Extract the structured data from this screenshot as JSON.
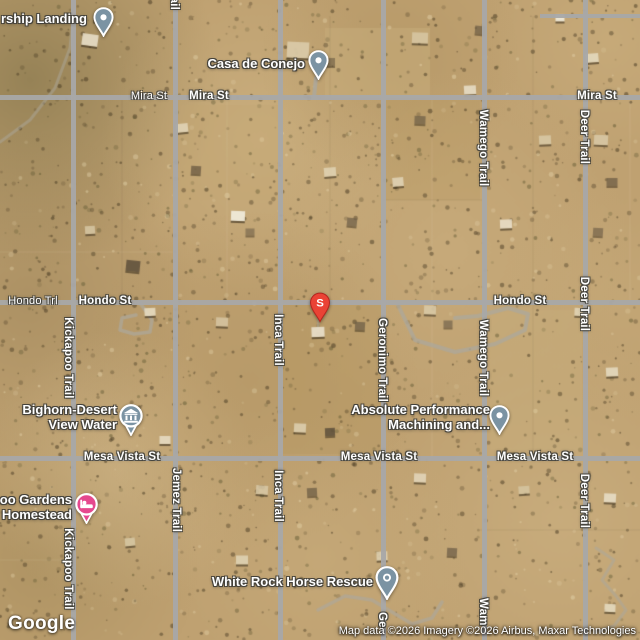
{
  "colors": {
    "terrain_base": "#bfa171",
    "road": "#a8a8a8",
    "poi_pin": "#7b93a3",
    "lodging_pin": "#e5488e",
    "search_pin": "#ea4335",
    "label_text": "#ffffff"
  },
  "search_marker": {
    "letter": "S"
  },
  "streets": [
    {
      "text": "z Trail"
    },
    {
      "text": "Mira St"
    },
    {
      "text": "Mira St"
    },
    {
      "text": "Mira St"
    },
    {
      "text": "Wamego Trail"
    },
    {
      "text": "Deer Trail"
    },
    {
      "text": "Hondo Trl"
    },
    {
      "text": "Hondo St"
    },
    {
      "text": "Hondo St"
    },
    {
      "text": "Kickapoo Trail"
    },
    {
      "text": "Inca Trail"
    },
    {
      "text": "Geronimo Trail"
    },
    {
      "text": "Wamego Trail"
    },
    {
      "text": "Deer Trail"
    },
    {
      "text": "Mesa Vista St"
    },
    {
      "text": "Mesa Vista St"
    },
    {
      "text": "Mesa Vista St"
    },
    {
      "text": "Jemez Trail"
    },
    {
      "text": "Inca Trail"
    },
    {
      "text": "Deer Trail"
    },
    {
      "text": "Kickapoo Trail"
    },
    {
      "text": "Ge"
    },
    {
      "text": "Wam"
    }
  ],
  "pois": {
    "rship_landing": {
      "line1": "rship Landing"
    },
    "casa_de_conejo": {
      "line1": "Casa de Conejo"
    },
    "bighorn": {
      "line1": "Bighorn-Desert",
      "line2": "View Water"
    },
    "absolute": {
      "line1": "Absolute Performance",
      "line2": "Machining and..."
    },
    "gardens": {
      "line1": "oo Gardens",
      "line2": "Homestead"
    },
    "white_rock": {
      "line1": "White Rock Horse Rescue"
    }
  },
  "logo": {
    "text": "Google"
  },
  "attribution": {
    "text": "Map data ©2026 Imagery ©2026 Airbus, Maxar Technologies"
  }
}
